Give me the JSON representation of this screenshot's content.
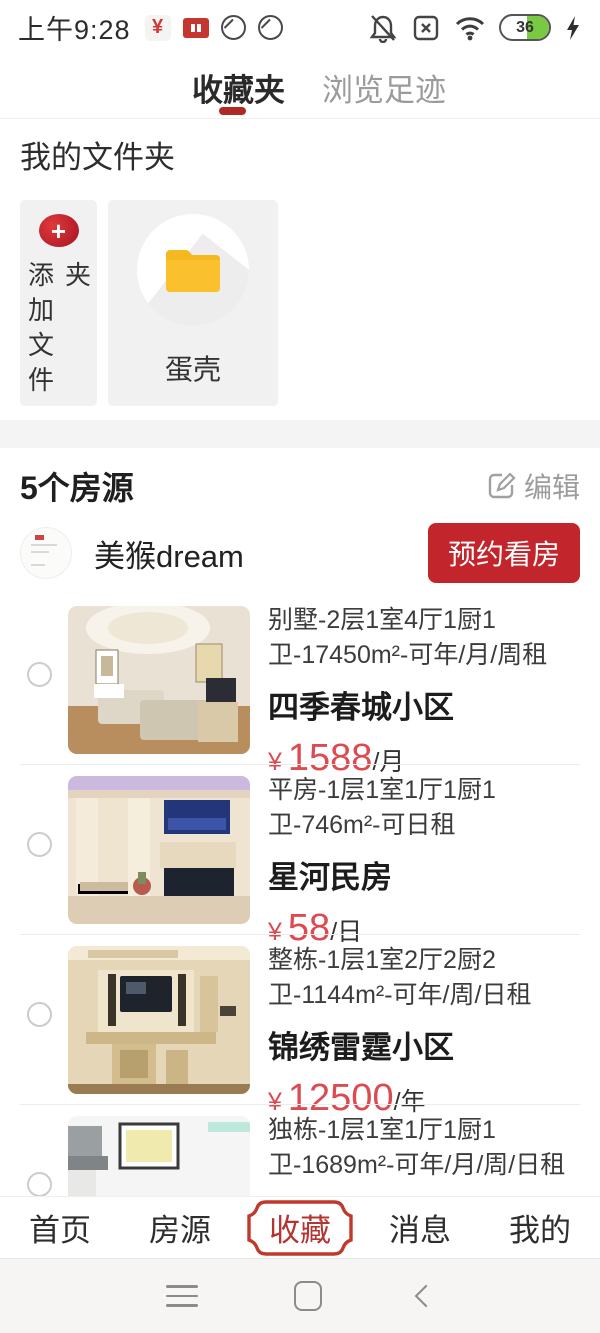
{
  "status_bar": {
    "time": "上午9:28",
    "battery_percent": "36"
  },
  "tabs": {
    "favorites": "收藏夹",
    "history": "浏览足迹"
  },
  "folders": {
    "heading": "我的文件夹",
    "add_label": "添加文件夹",
    "folder_name": "蛋壳"
  },
  "collection": {
    "count_label": "5个房源",
    "edit_label": "编辑",
    "landlord": {
      "name": "美猴dream",
      "book_label": "预约看房"
    },
    "listings": [
      {
        "desc": "别墅-2层1室4厅1厨1卫-17450m²-可年/月/周租",
        "name": "四季春城小区",
        "currency": "¥",
        "price": "1588",
        "unit": "/月"
      },
      {
        "desc": "平房-1层1室1厅1厨1卫-746m²-可日租",
        "name": "星河民房",
        "currency": "¥",
        "price": "58",
        "unit": "/日"
      },
      {
        "desc": "整栋-1层1室2厅2厨2卫-1144m²-可年/周/日租",
        "name": "锦绣雷霆小区",
        "currency": "¥",
        "price": "12500",
        "unit": "/年"
      },
      {
        "desc": "独栋-1层1室1厅1厨1卫-1689m²-可年/月/周/日租",
        "name": "世纪春城花园",
        "currency": "",
        "price": "",
        "unit": ""
      }
    ]
  },
  "bottom_nav": {
    "items": [
      "首页",
      "房源",
      "收藏",
      "消息",
      "我的"
    ],
    "active": "收藏"
  },
  "colors": {
    "accent_red": "#c2252b",
    "price_red": "#dc4b52",
    "underline_red": "#ad2b24",
    "battery_green": "#7ac943"
  }
}
